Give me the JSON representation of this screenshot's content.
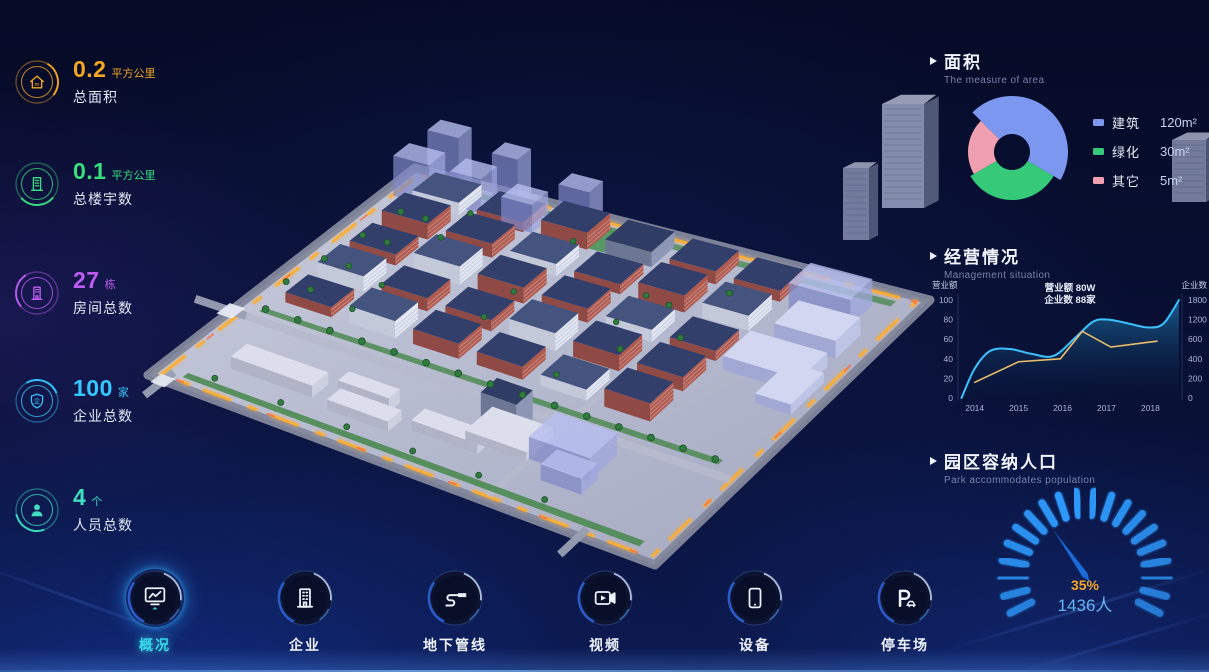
{
  "stats": [
    {
      "value": "0.2",
      "unit": "平方公里",
      "label": "总面积",
      "color": "#f5a623",
      "icon": "home-icon"
    },
    {
      "value": "0.1",
      "unit": "平方公里",
      "label": "总楼宇数",
      "color": "#38df7f",
      "icon": "building-icon"
    },
    {
      "value": "27",
      "unit": "栋",
      "label": "房间总数",
      "color": "#bd5cf0",
      "icon": "tower-icon"
    },
    {
      "value": "100",
      "unit": "家",
      "label": "企业总数",
      "color": "#35c8ff",
      "icon": "shield-icon"
    },
    {
      "value": "4",
      "unit": "个",
      "label": "人员总数",
      "color": "#3fdfc0",
      "icon": "person-icon"
    }
  ],
  "panels": {
    "area": {
      "title": "面积",
      "subtitle": "The measure of area",
      "legend": [
        {
          "label": "建筑",
          "value": "120m²",
          "color": "#7b97f0"
        },
        {
          "label": "绿化",
          "value": "30m²",
          "color": "#35c979"
        },
        {
          "label": "其它",
          "value": "5m²",
          "color": "#ef9fb0"
        }
      ]
    },
    "management": {
      "title": "经营情况",
      "subtitle": "Management situation"
    },
    "population": {
      "title": "园区容纳人口",
      "subtitle": "Park accommodates population",
      "percent": "35%",
      "count": "1436人"
    }
  },
  "nav": [
    {
      "label": "概况",
      "icon": "overview-monitor-icon",
      "active": true
    },
    {
      "label": "企业",
      "icon": "enterprise-building-icon",
      "active": false
    },
    {
      "label": "地下管线",
      "icon": "underground-pipeline-icon",
      "active": false
    },
    {
      "label": "视频",
      "icon": "video-camera-icon",
      "active": false
    },
    {
      "label": "设备",
      "icon": "device-tablet-icon",
      "active": false
    },
    {
      "label": "停车场",
      "icon": "parking-icon",
      "active": false
    }
  ],
  "chart_data": [
    {
      "type": "pie",
      "title": "面积",
      "legend_position": "right",
      "slices": [
        {
          "label": "建筑",
          "value": 120,
          "display": "120m²",
          "color": "#7b97f0",
          "a0": 135,
          "a1": -30,
          "r_outer": 56,
          "r_inner": 18
        },
        {
          "label": "绿化",
          "value": 30,
          "display": "30m²",
          "color": "#35c979",
          "a0": -30,
          "a1": -150,
          "r_outer": 48,
          "r_inner": 18
        },
        {
          "label": "其它",
          "value": 5,
          "display": "5m²",
          "color": "#ef9fb0",
          "a0": -150,
          "a1": -225,
          "r_outer": 44,
          "r_inner": 18
        }
      ]
    },
    {
      "type": "line",
      "title": "经营情况",
      "x_ticks": [
        "2014",
        "2015",
        "2016",
        "2017",
        "2018"
      ],
      "x_range": [
        2013.62,
        2018.72
      ],
      "left_axis": {
        "label": "营业额",
        "ticks": [
          0,
          20,
          40,
          60,
          80,
          100
        ],
        "range": [
          0,
          100
        ]
      },
      "right_axis": {
        "label": "企业数",
        "ticks": [
          0,
          200,
          400,
          600,
          1200,
          1800
        ]
      },
      "annotation": [
        "营业额 80W",
        "企业数 88家"
      ],
      "series": [
        {
          "name": "营业额",
          "color": "#3cc3ff",
          "area": true,
          "smooth": true,
          "x": [
            2013.7,
            2014.0,
            2014.35,
            2014.8,
            2015.3,
            2015.8,
            2016.3,
            2016.7,
            2017.05,
            2017.5,
            2017.95,
            2018.3,
            2018.65
          ],
          "y": [
            0,
            30,
            48,
            50,
            45,
            43,
            62,
            78,
            80,
            76,
            72,
            76,
            100
          ]
        },
        {
          "name": "企业数",
          "color": "#e9bd6a",
          "area": false,
          "smooth": false,
          "x": [
            2014.0,
            2015.0,
            2015.95,
            2016.45,
            2017.1,
            2018.15
          ],
          "y": [
            16,
            37,
            40,
            68,
            52,
            58
          ]
        }
      ]
    },
    {
      "type": "gauge",
      "title": "园区容纳人口",
      "percent": 35,
      "display_percent": "35%",
      "display_value": "1436人",
      "start_deg": 207,
      "end_deg": -27,
      "tick_count": 20,
      "tick_color": "#2f9bff",
      "needle_color": "#1a6bd8",
      "percent_color": "#f5a623",
      "value_color": "#66b5f2"
    }
  ]
}
